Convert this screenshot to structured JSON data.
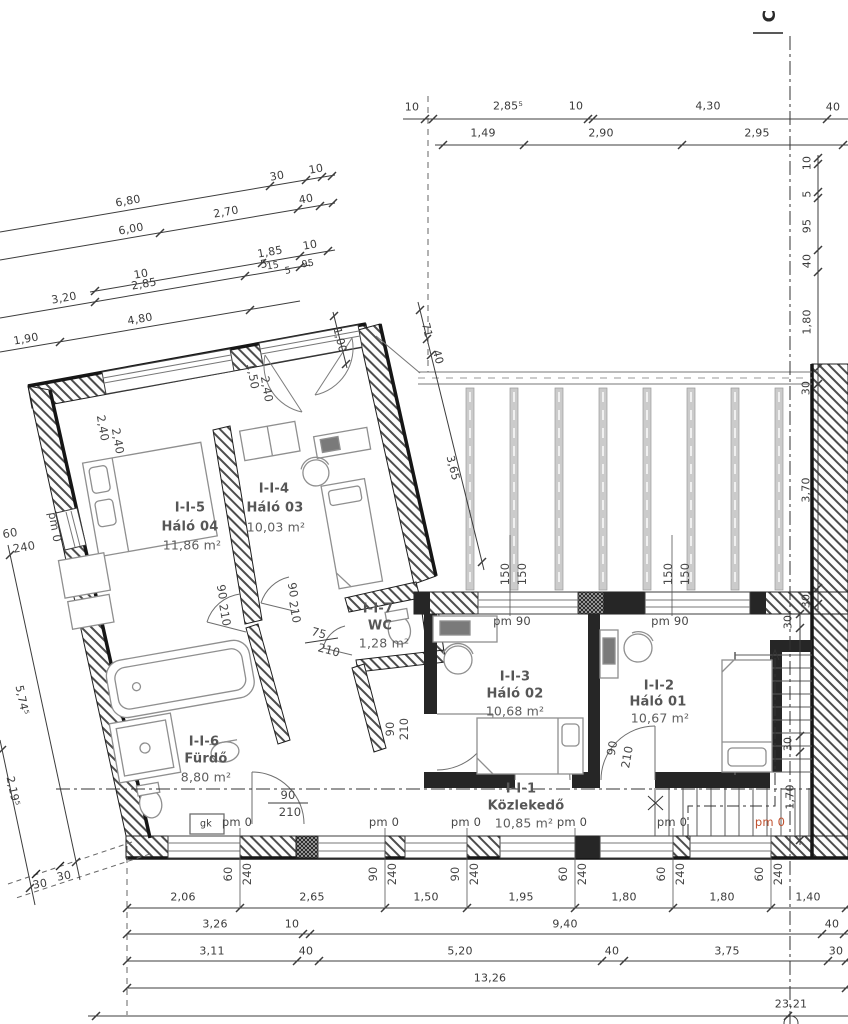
{
  "section_marker": "C",
  "rooms": [
    {
      "id": "I-I-5",
      "name": "Háló 04",
      "area": "11,86 m²"
    },
    {
      "id": "I-I-4",
      "name": "Háló 03",
      "area": "10,03 m²"
    },
    {
      "id": "I-I-7",
      "name": "WC",
      "area": "1,28 m²"
    },
    {
      "id": "I-I-6",
      "name": "Fürdő",
      "area": "8,80 m²"
    },
    {
      "id": "I-I-3",
      "name": "Háló 02",
      "area": "10,68 m²"
    },
    {
      "id": "I-I-2",
      "name": "Háló 01",
      "area": "10,67 m²"
    },
    {
      "id": "I-I-1",
      "name": "Közlekedő",
      "area": "10,85 m²"
    }
  ],
  "dims": {
    "top1": [
      "10",
      "2,85⁵",
      "10",
      "4,30",
      "40"
    ],
    "top2": [
      "1,49",
      "2,90",
      "2,95"
    ],
    "right": [
      "10",
      "5",
      "95",
      "40",
      "1,80",
      "30",
      "3,70",
      "30"
    ],
    "stairs_right": [
      "30",
      "30",
      "1,70"
    ],
    "bottom1": [
      "2,06",
      "2,65",
      "1,50",
      "1,95",
      "1,80",
      "1,80",
      "1,40"
    ],
    "bottom2": [
      "3,26",
      "10",
      "9,40",
      "40"
    ],
    "bottom3": [
      "3,11",
      "40",
      "5,20",
      "40",
      "3,75",
      "30"
    ],
    "bottom4": "13,26",
    "bottom5": "23,21",
    "wing1": [
      "6,80",
      "30",
      "10"
    ],
    "wing2": [
      "6,00",
      "2,70",
      "40"
    ],
    "wing3": [
      "10",
      "1,85",
      "10",
      "15",
      "5",
      "95"
    ],
    "wing4": [
      "3,20",
      "2,85",
      "5"
    ],
    "wing5": [
      "1,90",
      "4,80"
    ],
    "left_diag": [
      "5,74⁵",
      "2,19⁵"
    ],
    "corner": [
      "30",
      "30"
    ],
    "terrace": [
      "71",
      "40",
      "3,65",
      "1,00"
    ]
  },
  "openings": {
    "pm0": "pm 0",
    "pm90": "pm 90",
    "gk": "gk",
    "s60": "60",
    "s90": "90",
    "s240": "240",
    "s150": "150",
    "w240": "2,40",
    "w150": "1,50",
    "d90": "90",
    "d210": "210",
    "d75": "75"
  },
  "colors": {
    "pm0_highlight": "#c0512f",
    "wall": "#262626",
    "furniture": "#8f8f8f",
    "dim_text": "#3a3a3a"
  }
}
